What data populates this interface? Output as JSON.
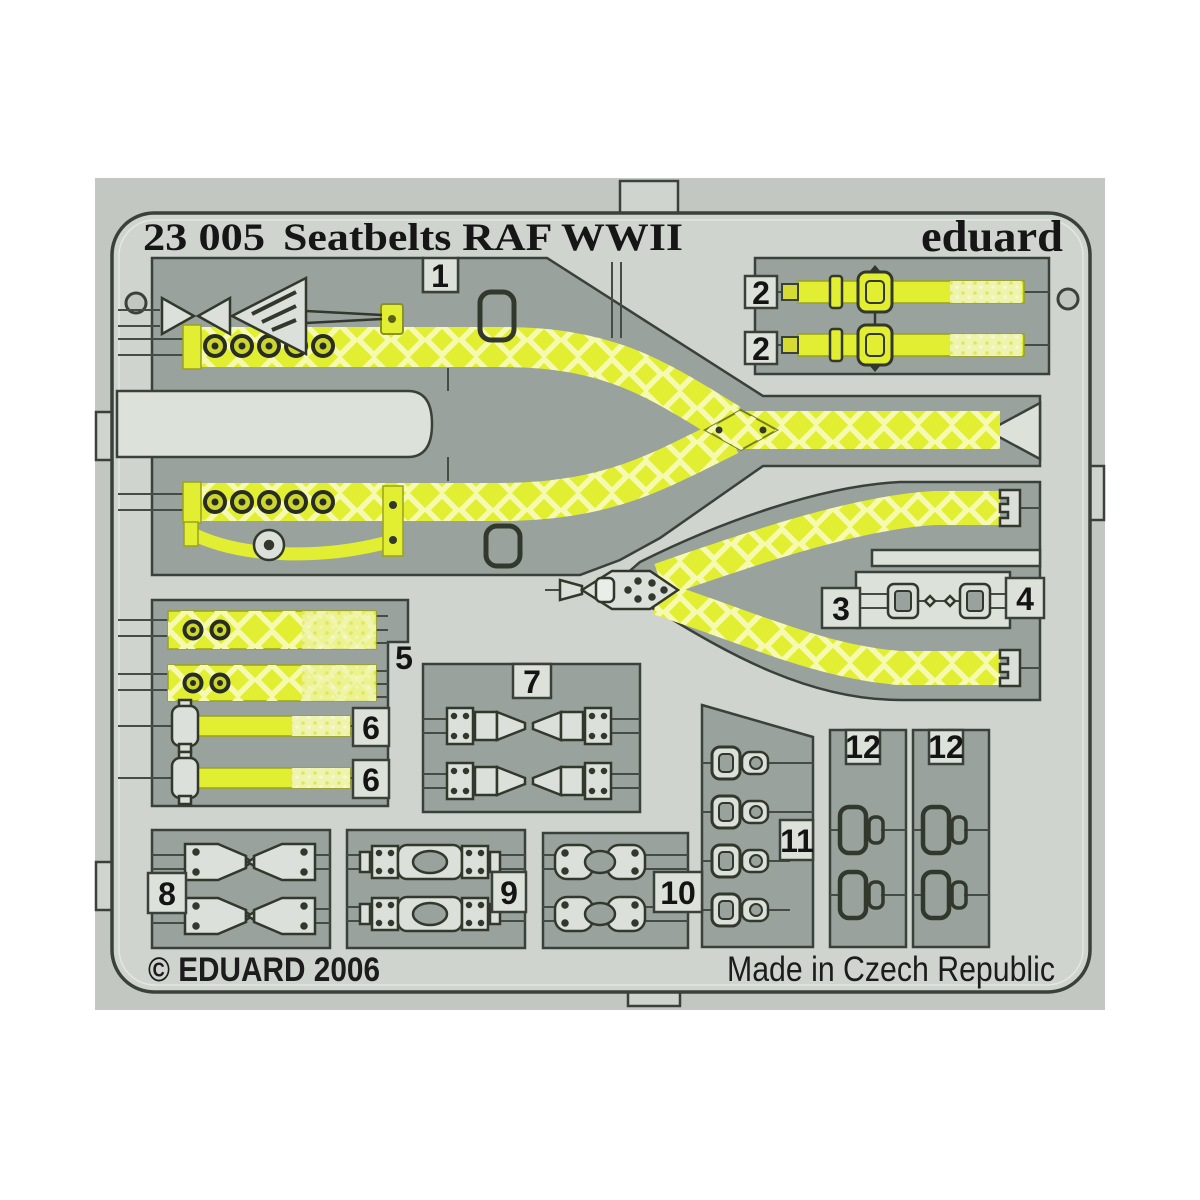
{
  "plate": {
    "product_code": "23 005",
    "product_name": "Seatbelts RAF WWII",
    "brand": "eduard",
    "copyright": "© EDUARD 2006",
    "made_in": "Made in Czech Republic"
  },
  "part_labels": {
    "n1": "1",
    "n2a": "2",
    "n2b": "2",
    "n3": "3",
    "n4": "4",
    "n5": "5",
    "n6a": "6",
    "n6b": "6",
    "n7": "7",
    "n8": "8",
    "n9": "9",
    "n10": "10",
    "n11": "11",
    "n12a": "12",
    "n12b": "12"
  },
  "colors": {
    "belt_yellow": "#e2ee32",
    "belt_hatch": "#f5fab0",
    "belt_pale": "#eef3ae",
    "fret_metal": "#cfd4ce",
    "panel_gray": "#99a29d",
    "cutout_light": "#dce1da",
    "outline_dark": "#3a403a",
    "photo_background": "#c2c7c1"
  }
}
